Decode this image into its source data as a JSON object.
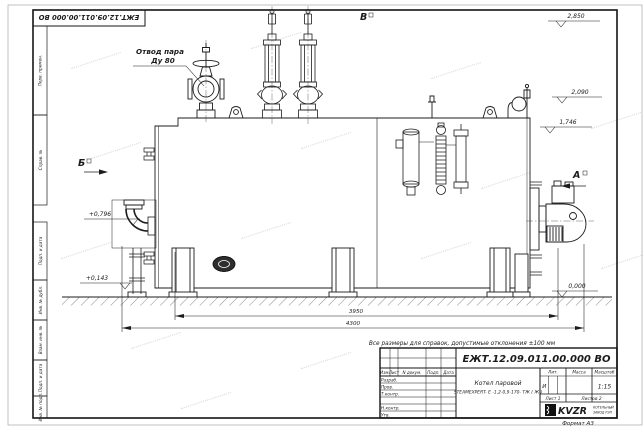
{
  "doc": {
    "number": "ЕЖТ.12.09.011.00.000  ВО",
    "format": "Формат А3"
  },
  "note": "Все размеры для справок, допустимые отклонения ±100 мм",
  "side_stamps": [
    "Перв. примен.",
    "Справ. №",
    "Подп. и дата",
    "Инв. № дубл.",
    "Взам. инв. №",
    "Подп. и дата",
    "Инв. № подл."
  ],
  "drawing": {
    "callouts": {
      "steam_line1": "Отвод пара",
      "steam_line2": "Ду 80"
    },
    "views": {
      "b": "Б",
      "a": "А",
      "v": "В"
    },
    "elevations": {
      "e2850": "2,850",
      "e2090": "2,090",
      "e1746": "1,746",
      "e0796": "+0,796",
      "e0143": "+0,143",
      "e0000": "0,000"
    },
    "dimensions": {
      "d3950": "3950",
      "d4300": "4300"
    }
  },
  "title_block": {
    "product_line1": "Котел паровой",
    "product_line2": "STEAMEXPERT- Е -1,2-0,9-170- ТЖ ( Ж )",
    "col_izm": "Изм.",
    "col_list": "Лист",
    "col_doc": "N докум.",
    "col_sign": "Подп.",
    "col_date": "Дата",
    "rows": [
      "Разраб.",
      "Пров.",
      "Т.контр.",
      "",
      "Н.контр.",
      "Утв."
    ],
    "lit_label": "Лит.",
    "mass_label": "Масса",
    "scale_label": "Масштаб",
    "lit_value": "И",
    "scale_value": "1:15",
    "sheet": "Лист 1",
    "sheets": "Листов 2",
    "company_logo": "KVZR",
    "company_line1": "КОТЕЛЬНЫЙ",
    "company_line2": "ЗАВОД РЭП"
  }
}
